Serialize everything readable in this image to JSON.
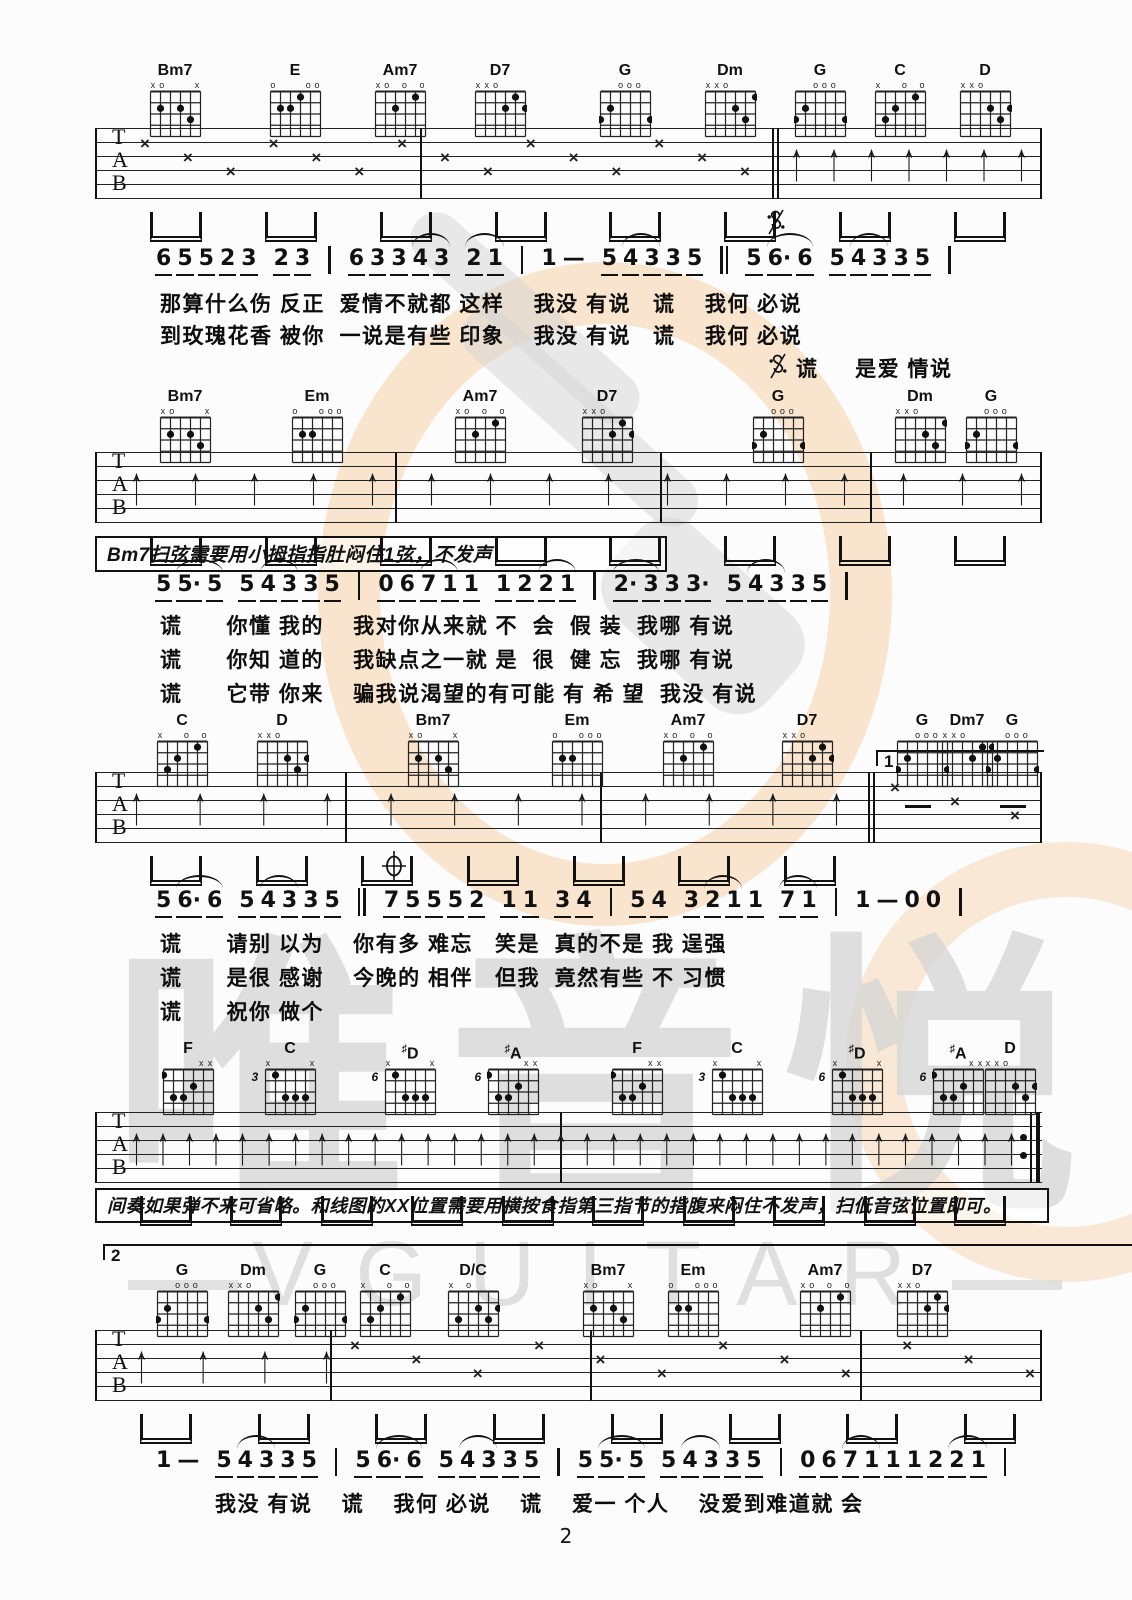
{
  "page": {
    "number": "2"
  },
  "watermark": {
    "brand_cn": "唯音悦",
    "brand_en": "VGUITAR",
    "circle_color": "#f6cb9e",
    "gray_color": "#d7d7d7"
  },
  "staff_letters": [
    "T",
    "A",
    "B"
  ],
  "annotations": {
    "bm7_note": "Bm7扫弦需要用小拇指指肚闷住1弦，不发声",
    "interlude_note": "间奏如果弹不来可省略。和线图的XX位置需要用横按食指第三指节的指腹来闷住不发声，扫低音弦位置即可。"
  },
  "chord_shapes": {
    "Bm7": {
      "label": "Bm7",
      "m": [
        "x",
        "o",
        "",
        "",
        "",
        "x"
      ],
      "d": [
        [
          1,
          2
        ],
        [
          3,
          2
        ],
        [
          4,
          3
        ]
      ]
    },
    "E": {
      "label": "E",
      "m": [
        "o",
        "",
        "",
        "",
        "o",
        "o"
      ],
      "d": [
        [
          1,
          2
        ],
        [
          2,
          2
        ],
        [
          3,
          1
        ]
      ]
    },
    "Am7": {
      "label": "Am7",
      "m": [
        "x",
        "o",
        "",
        "o",
        "",
        "o"
      ],
      "d": [
        [
          2,
          2
        ],
        [
          4,
          1
        ]
      ]
    },
    "D7": {
      "label": "D7",
      "m": [
        "x",
        "x",
        "o",
        "",
        "",
        ""
      ],
      "d": [
        [
          3,
          2
        ],
        [
          4,
          1
        ],
        [
          5,
          2
        ]
      ]
    },
    "G": {
      "label": "G",
      "m": [
        "",
        "",
        "o",
        "o",
        "o",
        ""
      ],
      "d": [
        [
          0,
          3
        ],
        [
          1,
          2
        ],
        [
          5,
          3
        ]
      ]
    },
    "Dm": {
      "label": "Dm",
      "m": [
        "x",
        "x",
        "o",
        "",
        "",
        ""
      ],
      "d": [
        [
          3,
          2
        ],
        [
          4,
          3
        ],
        [
          5,
          1
        ]
      ]
    },
    "C": {
      "label": "C",
      "m": [
        "x",
        "",
        "",
        "o",
        "",
        "o"
      ],
      "d": [
        [
          1,
          3
        ],
        [
          2,
          2
        ],
        [
          4,
          1
        ]
      ]
    },
    "D": {
      "label": "D",
      "m": [
        "x",
        "x",
        "o",
        "",
        "",
        ""
      ],
      "d": [
        [
          3,
          2
        ],
        [
          4,
          3
        ],
        [
          5,
          2
        ]
      ]
    },
    "Em": {
      "label": "Em",
      "m": [
        "o",
        "",
        "",
        "o",
        "o",
        "o"
      ],
      "d": [
        [
          1,
          2
        ],
        [
          2,
          2
        ]
      ]
    },
    "Dm7": {
      "label": "Dm7",
      "m": [
        "x",
        "x",
        "o",
        "",
        "",
        ""
      ],
      "d": [
        [
          3,
          2
        ],
        [
          4,
          1
        ],
        [
          5,
          1
        ]
      ]
    },
    "F": {
      "label": "F",
      "m": [
        "",
        "",
        "",
        "",
        "x",
        "x"
      ],
      "d": [
        [
          0,
          1
        ],
        [
          1,
          3
        ],
        [
          2,
          3
        ],
        [
          3,
          2
        ]
      ]
    },
    "C_3": {
      "label": "C",
      "fret": "3",
      "m": [
        "x",
        "",
        "",
        "",
        "",
        "x"
      ],
      "d": [
        [
          1,
          1
        ],
        [
          2,
          3
        ],
        [
          3,
          3
        ],
        [
          4,
          3
        ]
      ]
    },
    "Ds_6": {
      "label": "D",
      "sharp": true,
      "fret": "6",
      "m": [
        "x",
        "",
        "",
        "",
        "",
        "x"
      ],
      "d": [
        [
          1,
          1
        ],
        [
          2,
          3
        ],
        [
          3,
          3
        ],
        [
          4,
          3
        ]
      ]
    },
    "As_6": {
      "label": "A",
      "sharp": true,
      "fret": "6",
      "m": [
        "",
        "",
        "",
        "",
        "x",
        "x"
      ],
      "d": [
        [
          0,
          1
        ],
        [
          1,
          3
        ],
        [
          2,
          3
        ],
        [
          3,
          2
        ]
      ]
    },
    "DonC": {
      "label": "D/C",
      "m": [
        "x",
        "",
        "o",
        "",
        "",
        ""
      ],
      "d": [
        [
          1,
          3
        ],
        [
          3,
          2
        ],
        [
          4,
          3
        ],
        [
          5,
          2
        ]
      ]
    }
  },
  "systems": [
    {
      "chord_top": 62,
      "staff_top": 128,
      "chords": [
        {
          "s": "Bm7",
          "x": 142
        },
        {
          "s": "E",
          "x": 262
        },
        {
          "s": "Am7",
          "x": 367
        },
        {
          "s": "D7",
          "x": 467
        },
        {
          "s": "G",
          "x": 592
        },
        {
          "s": "Dm",
          "x": 697
        },
        {
          "s": "G",
          "x": 787
        },
        {
          "s": "C",
          "x": 867
        },
        {
          "s": "D",
          "x": 952
        }
      ],
      "bars": [
        95,
        420,
        1040
      ],
      "dbars": [
        772
      ],
      "deco": {
        "xs": {
          "x0": 140,
          "x1": 740,
          "n": 15
        },
        "arrows": {
          "x0": 790,
          "x1": 1015,
          "n": 7
        },
        "beams": {
          "x0": 150,
          "x1": 1000,
          "n": 8
        }
      },
      "segno": [
        766,
        208
      ]
    },
    {
      "chord_top": 388,
      "staff_top": 452,
      "chords": [
        {
          "s": "Bm7",
          "x": 152
        },
        {
          "s": "Em",
          "x": 284
        },
        {
          "s": "Am7",
          "x": 447
        },
        {
          "s": "D7",
          "x": 574
        },
        {
          "s": "G",
          "x": 745
        },
        {
          "s": "Dm",
          "x": 887
        },
        {
          "s": "G",
          "x": 958
        }
      ],
      "bars": [
        95,
        395,
        660,
        870,
        1040
      ],
      "dbars": [],
      "deco": {
        "arrows": {
          "x0": 130,
          "x1": 1015,
          "n": 16
        },
        "beams": {
          "x0": 150,
          "x1": 1000,
          "n": 8
        }
      }
    },
    {
      "chord_top": 712,
      "staff_top": 772,
      "chords": [
        {
          "s": "C",
          "x": 149
        },
        {
          "s": "D",
          "x": 249
        },
        {
          "s": "Bm7",
          "x": 400
        },
        {
          "s": "Em",
          "x": 544
        },
        {
          "s": "Am7",
          "x": 655
        },
        {
          "s": "D7",
          "x": 774
        },
        {
          "s": "G",
          "x": 889
        },
        {
          "s": "Dm7",
          "x": 934
        },
        {
          "s": "G",
          "x": 979
        }
      ],
      "bars": [
        95,
        345,
        600,
        1040
      ],
      "dbars": [
        868
      ],
      "volta": {
        "label": "1",
        "x0": 876,
        "x1": 1042,
        "y": 750
      },
      "deco": {
        "arrows": {
          "x0": 130,
          "x1": 830,
          "n": 12
        },
        "xs": {
          "x0": 890,
          "x1": 1010,
          "n": 3
        },
        "beams": {
          "x0": 150,
          "x1": 830,
          "n": 7
        },
        "dashes": [
          905,
          1000
        ]
      },
      "coda": [
        381,
        850
      ]
    },
    {
      "chord_top": 1040,
      "staff_top": 1112,
      "chords": [
        {
          "s": "F",
          "x": 155
        },
        {
          "s": "C_3",
          "x": 257
        },
        {
          "s": "Ds_6",
          "x": 377
        },
        {
          "s": "As_6",
          "x": 480
        },
        {
          "s": "F",
          "x": 604
        },
        {
          "s": "C_3",
          "x": 704
        },
        {
          "s": "Ds_6",
          "x": 824
        },
        {
          "s": "As_6",
          "x": 925
        },
        {
          "s": "D",
          "x": 977
        }
      ],
      "bars": [
        95,
        560
      ],
      "dbars": [],
      "endrepeat": 1030,
      "deco": {
        "arrows": {
          "x0": 130,
          "x1": 1005,
          "n": 34
        },
        "beams": {
          "x0": 140,
          "x1": 1000,
          "n": 10
        }
      }
    },
    {
      "chord_top": 1262,
      "staff_top": 1330,
      "chords": [
        {
          "s": "G",
          "x": 149
        },
        {
          "s": "Dm",
          "x": 220
        },
        {
          "s": "G",
          "x": 287
        },
        {
          "s": "C",
          "x": 352
        },
        {
          "s": "DonC",
          "x": 440
        },
        {
          "s": "Bm7",
          "x": 575
        },
        {
          "s": "Em",
          "x": 660
        },
        {
          "s": "Am7",
          "x": 792
        },
        {
          "s": "D7",
          "x": 889
        }
      ],
      "bars": [
        95,
        330,
        590,
        860,
        1040
      ],
      "dbars": [],
      "volta": {
        "label": "2",
        "x0": 103,
        "x1": 1256,
        "y": 1244
      },
      "deco": {
        "arrows": {
          "x0": 135,
          "x1": 320,
          "n": 4
        },
        "xs": {
          "x0": 350,
          "x1": 1025,
          "n": 12
        },
        "beams": {
          "x0": 140,
          "x1": 1010,
          "n": 8
        }
      }
    }
  ],
  "vocal_lines": [
    {
      "y": 246,
      "x": 155,
      "groups": [
        [
          "6",
          "5",
          "5",
          "2",
          "3"
        ],
        [
          "2",
          "3"
        ],
        [
          "|"
        ],
        [
          "6",
          "3",
          "3",
          "4",
          "3"
        ],
        [
          "2",
          "1"
        ],
        [
          "|"
        ],
        [
          "^1",
          "—"
        ],
        [
          "5",
          "4",
          "3",
          "3",
          "5"
        ],
        [
          "||"
        ],
        [
          "5",
          "6·",
          "6"
        ],
        [
          "5",
          "4",
          "3",
          "3",
          "5"
        ],
        [
          "|"
        ]
      ],
      "lyrics": [
        {
          "x": 160,
          "y": 288,
          "t": "那算什么伤 反正  爱情不就都 这样    我没 有说   谎    我何 必说"
        },
        {
          "x": 160,
          "y": 320,
          "t": "到玫瑰花香 被你  一说是有些 印象    我没 有说   谎    我何 必说"
        },
        {
          "x": 768,
          "y": 352,
          "t": "谎     是爱 情说",
          "segno": true
        }
      ]
    },
    {
      "y": 572,
      "x": 155,
      "groups": [
        [
          "5",
          "5·",
          "5"
        ],
        [
          "5",
          "4",
          "3",
          "3",
          "5"
        ],
        [
          "|"
        ],
        [
          "0",
          "6",
          "7",
          "1",
          "1"
        ],
        [
          "1",
          "2",
          "2",
          "1"
        ],
        [
          "|"
        ],
        [
          "2·",
          "3",
          "3",
          "3·"
        ],
        [
          "5",
          "4",
          "3",
          "3",
          "5"
        ],
        [
          "|"
        ]
      ],
      "lyrics": [
        {
          "x": 160,
          "y": 610,
          "t": "谎      你懂 我的    我对你从来就 不  会  假 装  我哪 有说"
        },
        {
          "x": 160,
          "y": 644,
          "t": "谎      你知 道的    我缺点之一就 是  很  健 忘  我哪 有说"
        },
        {
          "x": 160,
          "y": 678,
          "t": "谎      它带 你来    骗我说渴望的有可能 有 希 望  我没 有说"
        }
      ]
    },
    {
      "y": 888,
      "x": 155,
      "groups": [
        [
          "5",
          "6·",
          "6"
        ],
        [
          "5",
          "4",
          "3",
          "3",
          "5"
        ],
        [
          "||"
        ],
        [
          "7",
          "5",
          "5",
          "5",
          "2"
        ],
        [
          "1",
          "1"
        ],
        [
          "3",
          "4"
        ],
        [
          "|"
        ],
        [
          "5",
          "4"
        ],
        [
          "3",
          "2",
          "1",
          "1"
        ],
        [
          "7",
          "1"
        ],
        [
          "|"
        ],
        [
          "^1",
          "—",
          "^0",
          "^0"
        ],
        [
          "|"
        ]
      ],
      "lyrics": [
        {
          "x": 160,
          "y": 928,
          "t": "谎      请别 以为    你有多 难忘   笑是  真的不是 我 逞强"
        },
        {
          "x": 160,
          "y": 962,
          "t": "谎      是很 感谢    今晚的 相伴   但我  竟然有些 不 习惯"
        },
        {
          "x": 160,
          "y": 996,
          "t": "谎      祝你 做个"
        }
      ]
    },
    {
      "y": 1448,
      "x": 155,
      "groups": [
        [
          "^1",
          "—"
        ],
        [
          "5",
          "4",
          "3",
          "3",
          "5"
        ],
        [
          "|"
        ],
        [
          "5",
          "6·",
          "6"
        ],
        [
          "5",
          "4",
          "3",
          "3",
          "5"
        ],
        [
          "|"
        ],
        [
          "5",
          "5·",
          "5"
        ],
        [
          "5",
          "4",
          "3",
          "3",
          "5"
        ],
        [
          "|"
        ],
        [
          "0",
          "6",
          "7",
          "1",
          "1",
          "1",
          "2",
          "2",
          "1"
        ],
        [
          "|"
        ]
      ],
      "lyrics": [
        {
          "x": 215,
          "y": 1488,
          "t": "我没 有说    谎    我何 必说    谎    爱一 个人    没爱到难道就 会"
        }
      ]
    }
  ]
}
